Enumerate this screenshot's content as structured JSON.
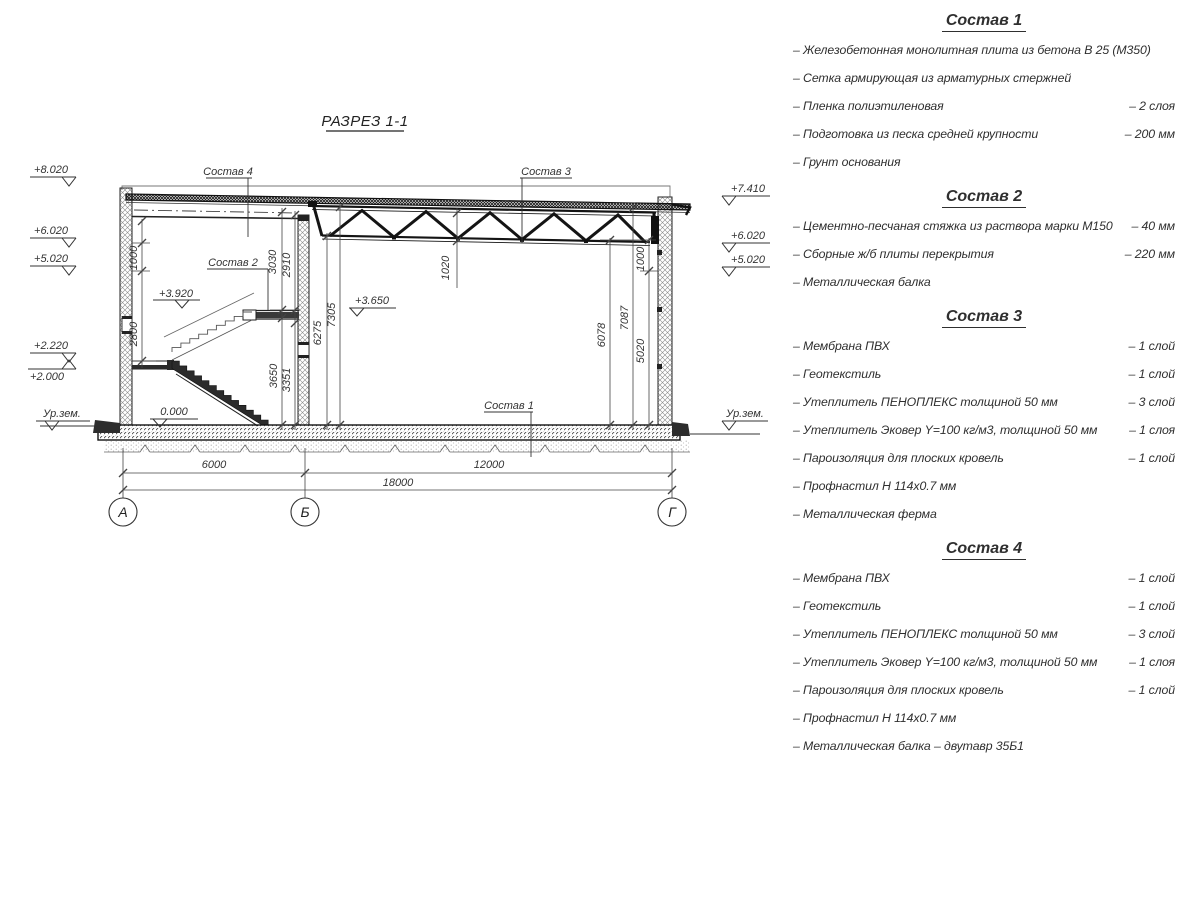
{
  "title": "РАЗРЕЗ 1-1",
  "drawing": {
    "callouts": {
      "c1": "Состав 1",
      "c2": "Состав 2",
      "c3": "Состав 3",
      "c4": "Состав 4"
    },
    "elev": {
      "e8020": "+8.020",
      "e6020": "+6.020",
      "e5020": "+5.020",
      "e2220": "+2.220",
      "e2000": "+2.000",
      "e7410": "+7.410",
      "ground": "Ур.зем.",
      "l3920": "+3.920",
      "l3650": "+3.650",
      "l0": "0.000"
    },
    "dims": {
      "d1000l": "1000",
      "d2800": "2800",
      "d3030": "3030",
      "d2910": "2910",
      "d7305": "7305",
      "d6275": "6275",
      "d3650": "3650",
      "d3351": "3351",
      "d1020": "1020",
      "d6078": "6078",
      "d7087": "7087",
      "d5020": "5020",
      "d1000r": "1000",
      "d6000": "6000",
      "d12000": "12000",
      "d18000": "18000"
    },
    "axes": {
      "a": "А",
      "b": "Б",
      "g": "Г"
    }
  },
  "compositions": [
    {
      "title": "Состав 1",
      "items": [
        {
          "label": "– Железобетонная монолитная плита из бетона В 25 (М350)",
          "value": ""
        },
        {
          "label": "– Сетка армирующая из арматурных стержней",
          "value": ""
        },
        {
          "label": "– Пленка полиэтиленовая",
          "value": "– 2 слоя"
        },
        {
          "label": "– Подготовка из песка средней крупности",
          "value": "– 200 мм"
        },
        {
          "label": "– Грунт основания",
          "value": ""
        }
      ]
    },
    {
      "title": "Состав 2",
      "items": [
        {
          "label": "– Цементно-песчаная стяжка из раствора марки М150",
          "value": "– 40 мм"
        },
        {
          "label": "– Сборные ж/б плиты перекрытия",
          "value": "– 220 мм"
        },
        {
          "label": "– Металлическая балка",
          "value": ""
        }
      ]
    },
    {
      "title": "Состав 3",
      "items": [
        {
          "label": "– Мембрана ПВХ",
          "value": "– 1 слой"
        },
        {
          "label": "– Геотекстиль",
          "value": "– 1 слой"
        },
        {
          "label": "– Утеплитель ПЕНОПЛЕКС толщиной 50 мм",
          "value": "– 3 слой"
        },
        {
          "label": "– Утеплитель Эковер Y=100 кг/м3, толщиной 50 мм",
          "value": "– 1 слоя"
        },
        {
          "label": "– Пароизоляция для плоских кровель",
          "value": "– 1 слой"
        },
        {
          "label": "– Профнастил Н 114х0.7 мм",
          "value": ""
        },
        {
          "label": "– Металлическая ферма",
          "value": ""
        }
      ]
    },
    {
      "title": "Состав 4",
      "items": [
        {
          "label": "– Мембрана ПВХ",
          "value": "– 1 слой"
        },
        {
          "label": "– Геотекстиль",
          "value": "– 1 слой"
        },
        {
          "label": "– Утеплитель ПЕНОПЛЕКС толщиной 50 мм",
          "value": "– 3 слой"
        },
        {
          "label": "– Утеплитель Эковер Y=100 кг/м3, толщиной 50 мм",
          "value": "– 1 слоя"
        },
        {
          "label": "– Пароизоляция для плоских кровель",
          "value": "– 1 слой"
        },
        {
          "label": "– Профнастил Н 114х0.7 мм",
          "value": ""
        },
        {
          "label": "– Металлическая балка – двутавр 35Б1",
          "value": ""
        }
      ]
    }
  ]
}
